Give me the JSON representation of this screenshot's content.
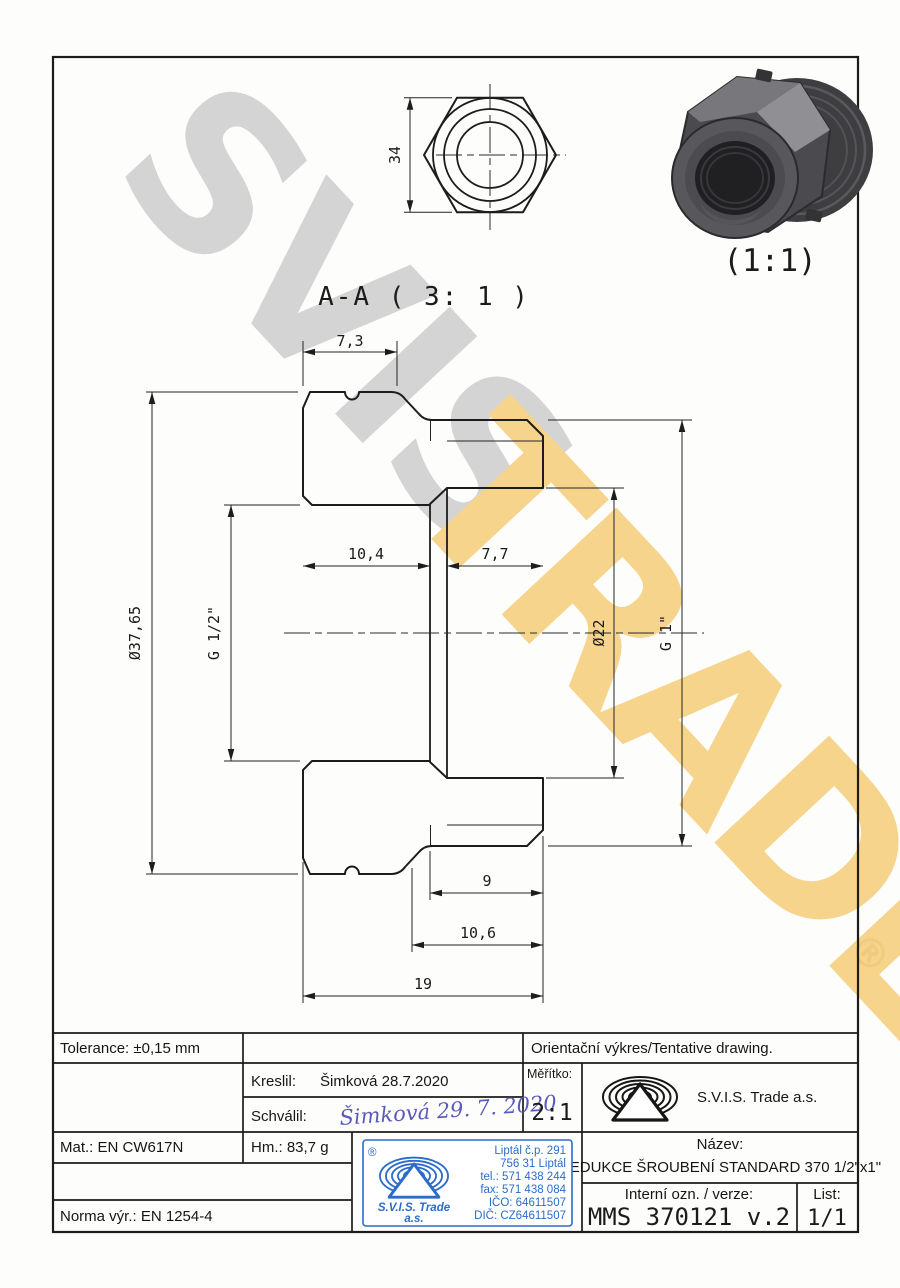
{
  "watermark": {
    "word1": "SVIS",
    "word2": "TRADE",
    "registered": "®"
  },
  "colors": {
    "stamp_blue": "#2b6cc9",
    "watermark_gold": "#f6d48c",
    "watermark_gray": "#d4d4d4",
    "line": "#1c1c1c"
  },
  "top_view": {
    "across_flats": "34"
  },
  "iso_view": {
    "scale_label": "(1:1)"
  },
  "section": {
    "title": "A-A ( 3: 1 )",
    "dim_top_width": "7,3",
    "dim_left_bore_depth": "10,4",
    "dim_right_bore_depth": "7,7",
    "dim_outer_dia": "Ø37,65",
    "dim_left_thread": "G 1/2\"",
    "dim_right_bore_dia": "Ø22",
    "dim_right_thread": "G 1\"",
    "dim_thread_length": "9",
    "dim_cylinder_length": "10,6",
    "dim_total_length": "19"
  },
  "title_block": {
    "tolerance": "Tolerance: ±0,15 mm",
    "orientation_note": "Orientační výkres/Tentative drawing.",
    "kreslil_label": "Kreslil:",
    "kreslil_value": "Šimková 28.7.2020",
    "schvalil_label": "Schválil:",
    "schvalil_signature": "Šimková 29. 7. 2020",
    "meritko_label": "Měřítko:",
    "meritko_value": "2:1",
    "company": "S.V.I.S. Trade a.s.",
    "mat": "Mat.: EN CW617N",
    "hm": "Hm.: 83,7 g",
    "norma": "Norma výr.: EN 1254-4",
    "nazev_label": "Název:",
    "nazev_value": "REDUKCE ŠROUBENÍ STANDARD 370 1/2\"x1\"",
    "interni_label": "Interní ozn. / verze:",
    "interni_value": "MMS 370121 v.2",
    "list_label": "List:",
    "list_value": "1/1",
    "stamp": {
      "registered": "®",
      "line1": "Liptál č.p. 291",
      "line2": "756 31 Liptál",
      "line3": "tel.: 571 438 244",
      "line4": "fax: 571 438 084",
      "line5": "IČO: 64611507",
      "line6": "DIČ: CZ64611507",
      "company": "S.V.I.S. Trade",
      "suffix": "a.s."
    }
  }
}
